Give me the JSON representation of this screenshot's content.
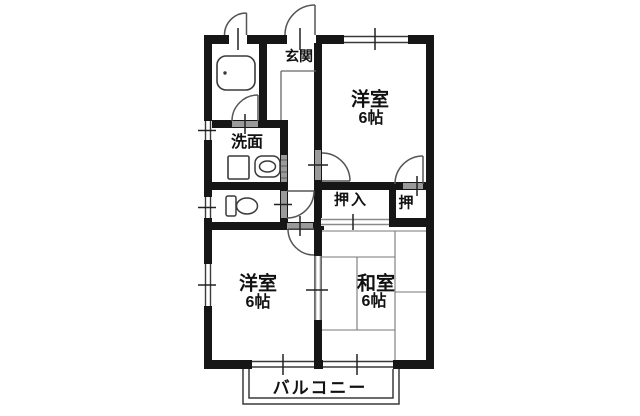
{
  "floorplan": {
    "type": "apartment-floor-plan",
    "rooms": {
      "genkan": {
        "label": "玄関"
      },
      "western_room_top": {
        "label": "洋室",
        "size": "6帖"
      },
      "washroom": {
        "label": "洗面"
      },
      "oshiire_closet": {
        "label": "押入"
      },
      "oshi_closet": {
        "label": "押"
      },
      "western_room_bottom": {
        "label": "洋室",
        "size": "6帖"
      },
      "japanese_room": {
        "label": "和室",
        "size": "6帖"
      },
      "balcony": {
        "label": "バルコニー"
      }
    },
    "fixtures": [
      "bathtub-icon",
      "washing-machine-icon",
      "sink-icon",
      "toilet-icon"
    ],
    "colors": {
      "wall": "#161616",
      "line": "#3a3a3a",
      "opening": "#9a9a9a",
      "background": "#ffffff"
    }
  }
}
